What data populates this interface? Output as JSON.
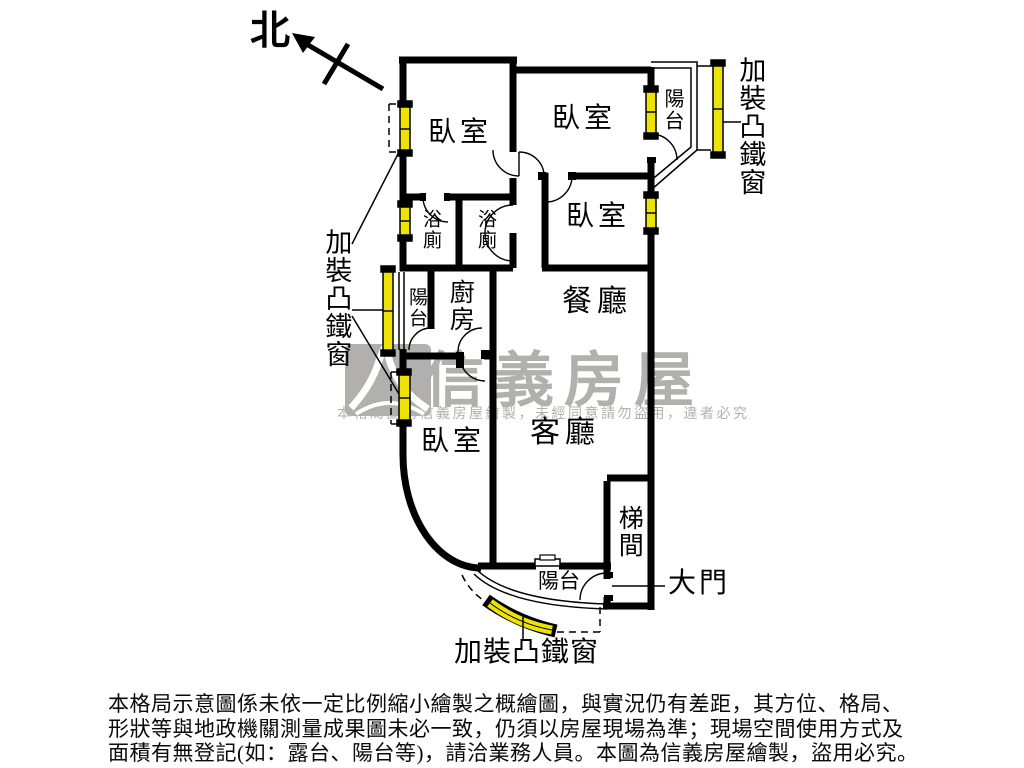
{
  "north": {
    "label": "北"
  },
  "rooms": {
    "bedroom_top_left": "臥室",
    "bedroom_top_middle": "臥室",
    "bedroom_middle_right": "臥室",
    "bedroom_bottom_left": "臥室",
    "dining": "餐廳",
    "living": "客廳",
    "kitchen": "廚房",
    "bath_left": "浴廁",
    "bath_right": "浴廁",
    "balcony_left": "陽台",
    "balcony_top_right": "陽台",
    "balcony_bottom": "陽台",
    "stairwell": "梯間"
  },
  "annotations": {
    "iron_window_right": "加裝凸鐵窗",
    "iron_window_left": "加裝凸鐵窗",
    "iron_window_bottom": "加裝凸鐵窗",
    "main_door": "大門"
  },
  "watermark": {
    "brand": "信義房屋",
    "notice": "本格局圖為信義房屋繪製，未經同意請勿盜用，違者必究"
  },
  "disclaimer": {
    "line1": "本格局示意圖係未依一定比例縮小繪製之概繪圖，與實況仍有差距，其方位、格局、",
    "line2": "形狀等與地政機關測量成果圖未必一致，仍須以房屋現場為準；現場空間使用方式及",
    "line3": "面積有無登記(如：露台、陽台等)，請洽業務人員。本圖為信義房屋繪製，盜用必究。"
  },
  "colors": {
    "wall": "#000000",
    "window_yellow": "#ede307",
    "watermark_gray": "#b1b0ae"
  }
}
